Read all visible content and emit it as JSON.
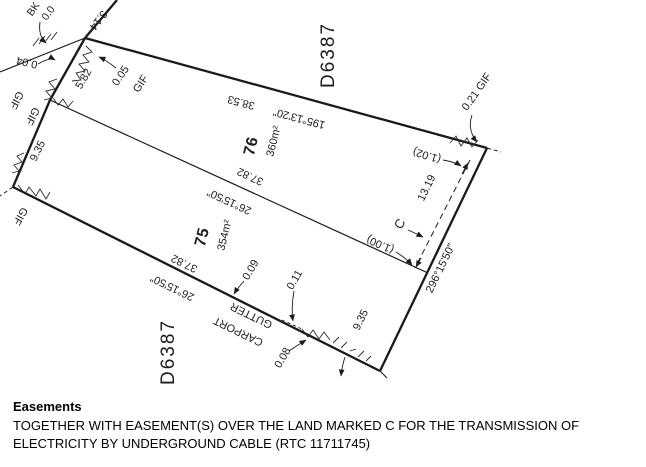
{
  "plan": {
    "plan_number_top": "D6387",
    "plan_number_bottom": "D6387",
    "lot76": {
      "number": "76",
      "area": "360m²"
    },
    "lot75": {
      "number": "75",
      "area": "354m²"
    },
    "bearings": {
      "top_bearing": "195°13'20\"",
      "top_distance": "38.53",
      "mid_bearing": "26°15'50\"",
      "mid_distance": "37.82",
      "bottom_bearing": "26°15'50\"",
      "bottom_distance": "37.82",
      "right_bearing": "296°15'50\""
    },
    "dimensions": {
      "d314": "3.14",
      "d004": "0.04",
      "d582": "5.82",
      "d005": "0.05",
      "d021gif": "0.21 GIF",
      "p102": "(1.02)",
      "p100": "(1.00)",
      "d1319": "13.19",
      "d935_left": "9.35",
      "d935_right": "9.35",
      "d009": "0.09",
      "d011": "0.11",
      "d008": "0.08"
    },
    "fence_labels": {
      "bk": "BK",
      "bk_val": "0.0",
      "gif1": "GIF",
      "gif2": "GIF",
      "gif3": "GIF",
      "gif4": "GIF"
    },
    "easement_mark": "C",
    "structures": {
      "carport": "CARPORT",
      "gutter": "GUTTER"
    }
  },
  "easements_section": {
    "heading": "Easements",
    "body": "TOGETHER WITH EASEMENT(S) OVER THE LAND MARKED C FOR THE TRANSMISSION OF ELECTRICITY BY UNDERGROUND CABLE (RTC 11711745)"
  }
}
